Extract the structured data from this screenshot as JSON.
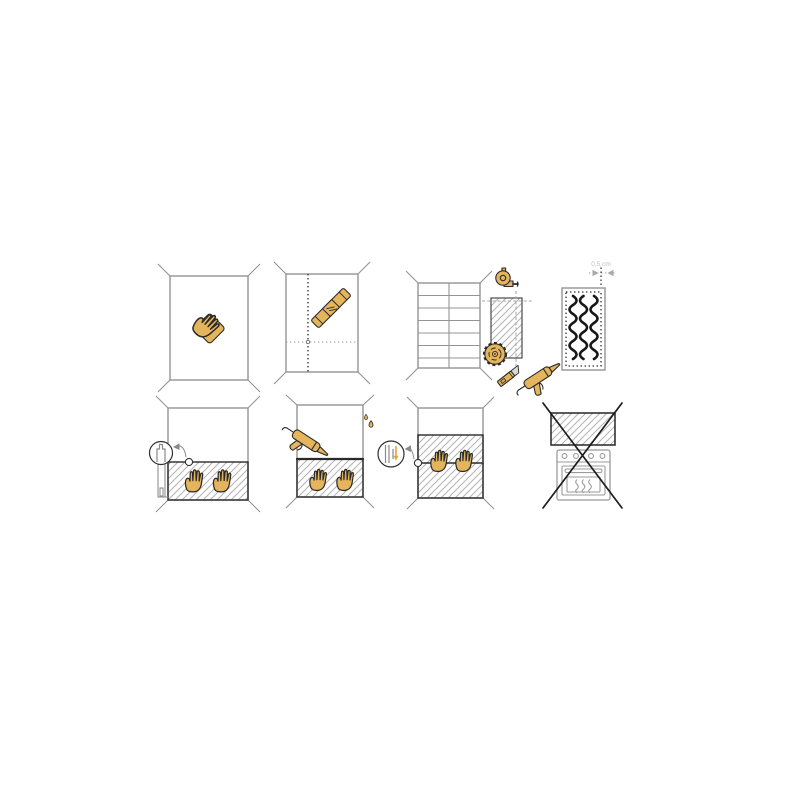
{
  "figure": {
    "rows": 2,
    "columns": 4,
    "step_count": 8
  },
  "colors": {
    "background": "#ffffff",
    "tool_yellow": "#e4b55c",
    "outline_dark": "#2a2a2a",
    "wall_gray": "#949494",
    "hatch_gray": "#b3b3b3",
    "label_gray": "#bdbdbd",
    "blade_gray": "#d8d8d8"
  },
  "labels": {
    "gap_width": "0,5 cm"
  },
  "steps": [
    {
      "number": 1,
      "name": "clean-wall",
      "icons": [
        "wall",
        "hand-cloth-icon"
      ]
    },
    {
      "number": 2,
      "name": "mark-guide-lines",
      "icons": [
        "wall",
        "plumb-dotted-line",
        "level-dotted-line",
        "spirit-level-icon"
      ]
    },
    {
      "number": 3,
      "name": "measure-and-cut-panel",
      "icons": [
        "tiled-wall",
        "panel-cut-piece",
        "measuring-tape-icon",
        "circular-saw-blade-icon",
        "utility-knife-icon"
      ]
    },
    {
      "number": 4,
      "name": "apply-adhesive-to-panel-back",
      "icons": [
        "panel-back",
        "adhesive-beads",
        "caulking-gun-icon"
      ],
      "gap_label": "0,5 cm"
    },
    {
      "number": 5,
      "name": "mount-panel-on-support-rail",
      "icons": [
        "wall",
        "panel",
        "hands-pressing",
        "support-rail-icon",
        "magnifier-detail",
        "detail-arrow"
      ]
    },
    {
      "number": 6,
      "name": "seal-top-edge",
      "icons": [
        "wall",
        "panel",
        "hands-pressing",
        "caulking-gun-icon",
        "sealant-droplets-icon"
      ]
    },
    {
      "number": 7,
      "name": "join-second-panel",
      "icons": [
        "wall",
        "panels-joined",
        "hands-pressing",
        "joint-magnifier-detail",
        "down-arrow-icon"
      ]
    },
    {
      "number": 8,
      "name": "do-not-install-above-stove",
      "icons": [
        "panel",
        "oven-icon",
        "prohibition-cross-icon"
      ]
    }
  ]
}
